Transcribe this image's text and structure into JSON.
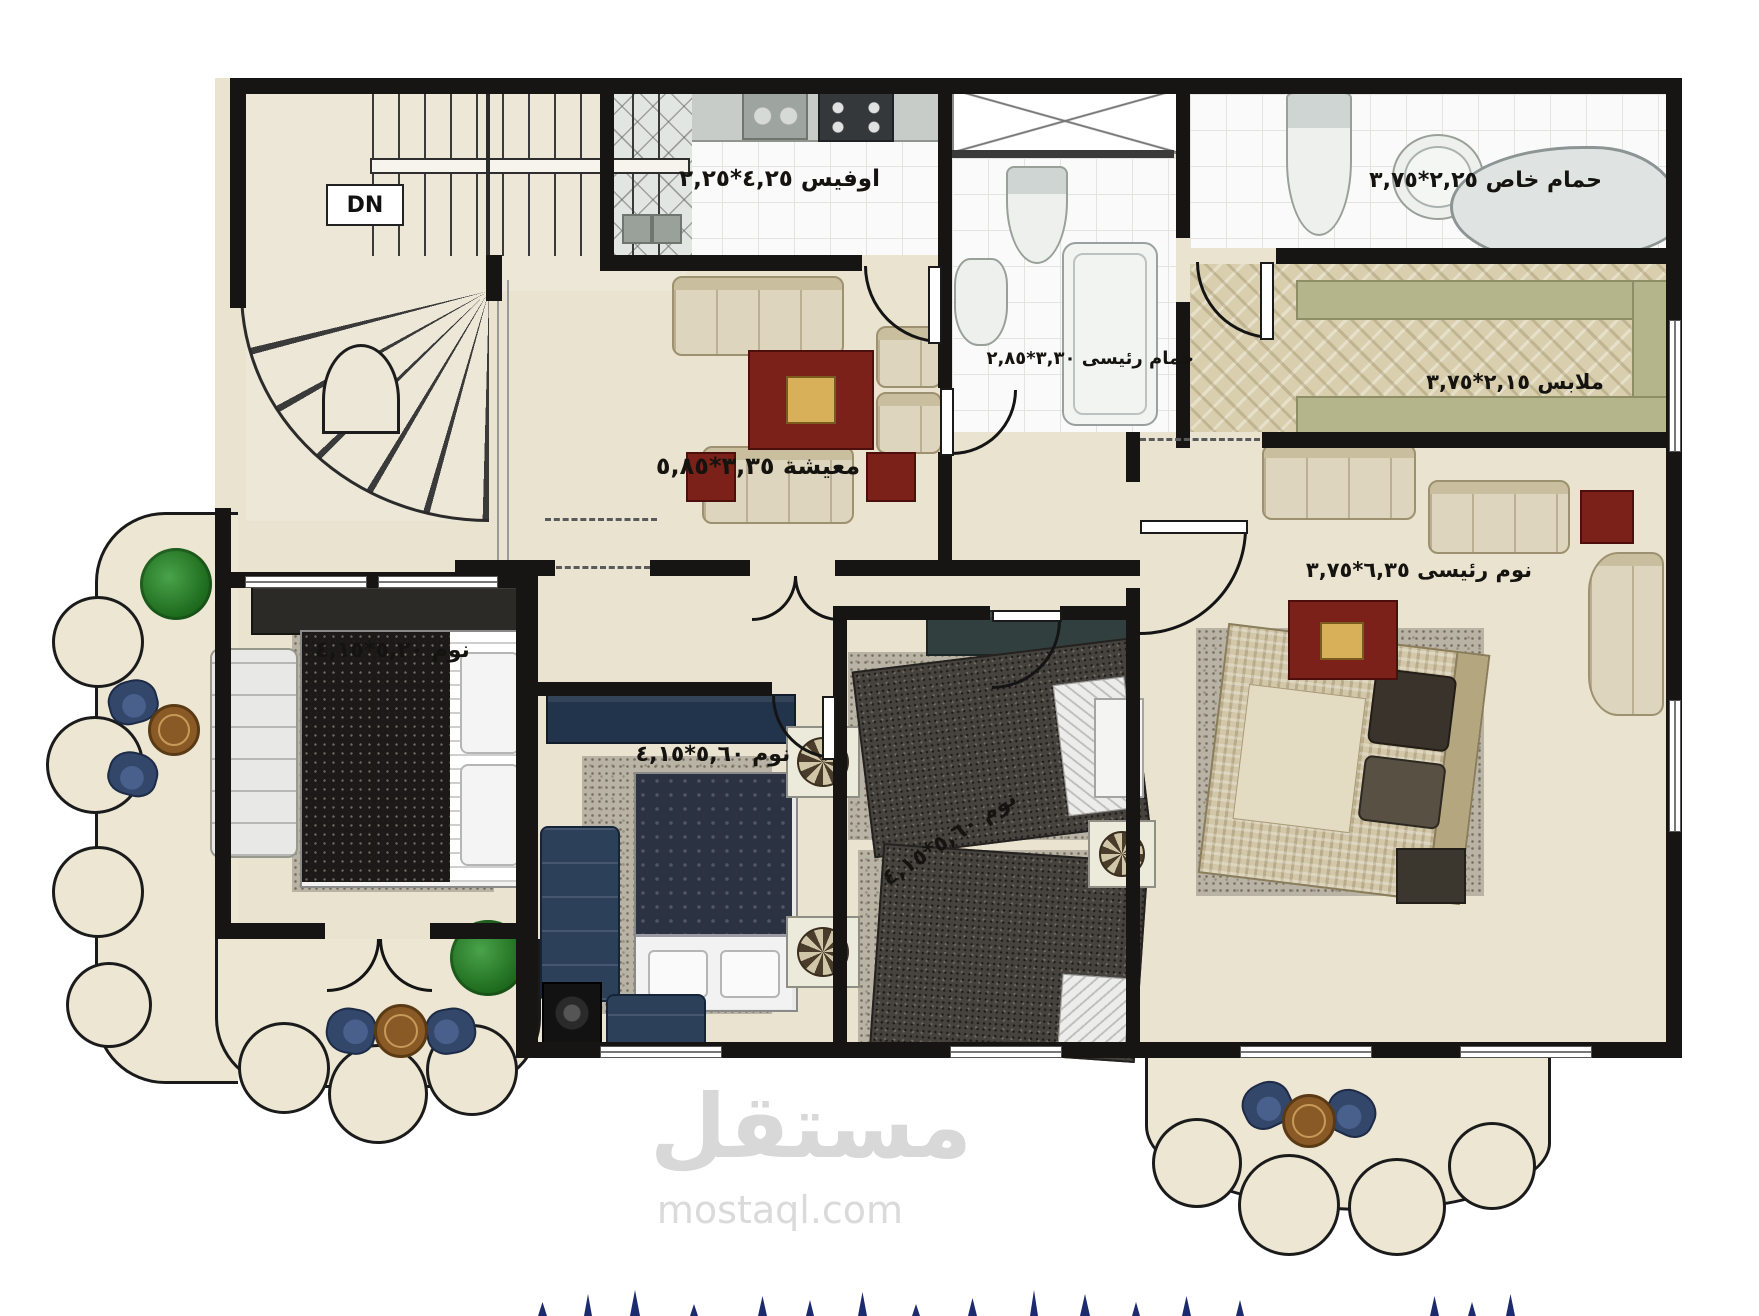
{
  "plan_title": "apartment-floor-plan",
  "stairs": {
    "dn_label": "DN"
  },
  "rooms": {
    "office": {
      "label": "اوفيس ٤,٢٥*٢,٢٥"
    },
    "main_bathroom": {
      "label": "حمام رئيسى ٣,٣٠*٢,٨٥"
    },
    "private_bathroom": {
      "label": "حمام خاص ٢,٢٥*٣,٧٥"
    },
    "dressing": {
      "label": "ملابس ٢,١٥*٣,٧٥"
    },
    "living": {
      "label": "معيشة ٣,٣٥*٥,٨٥"
    },
    "master_bedroom": {
      "label": "نوم رئيسى ٦,٣٥*٣,٧٥"
    },
    "bedroom_left": {
      "label": "نوم ٥,٢٠*٤,١٥"
    },
    "bedroom_middle": {
      "label": "نوم ٥,٦٠*٤,١٥"
    },
    "bedroom_back": {
      "label": "نوم ٥,٦٠*٤,١٥"
    }
  },
  "watermark": {
    "logo": "مستقل",
    "site": "mostaql.com"
  },
  "colors": {
    "wall": "#171513",
    "marble_floor": "#e9e3cf",
    "parquet_floor": "#d9cfae",
    "closet_olive": "#b5b58b",
    "furniture_navy": "#2c4059",
    "rug_red": "#7c211a",
    "caption_navy": "#1c2a6e",
    "watermark_gray": "#d8d8d8"
  }
}
